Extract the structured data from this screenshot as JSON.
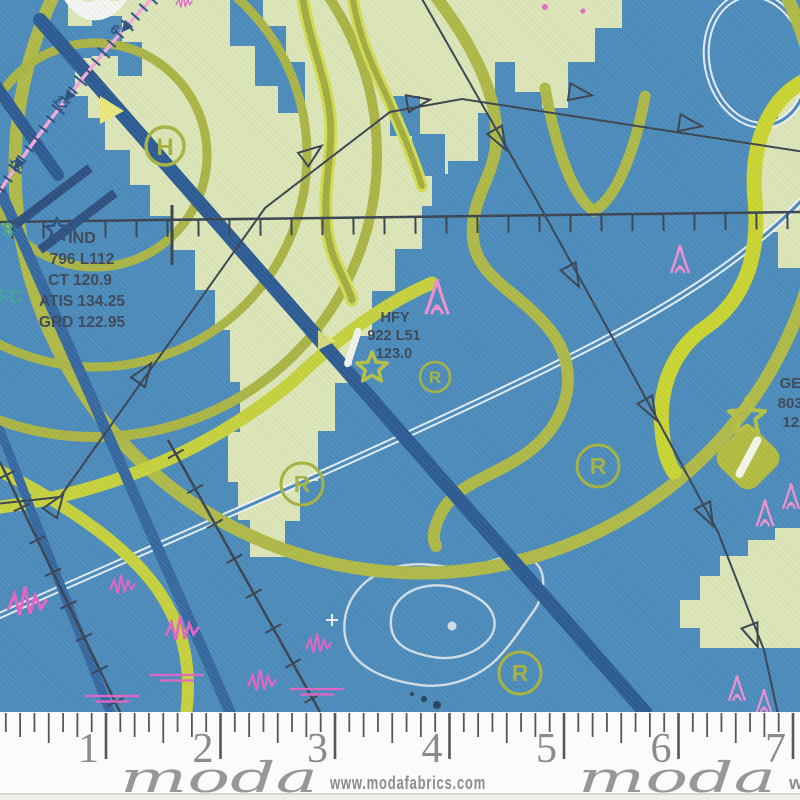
{
  "fabric": {
    "airports": {
      "ind": {
        "name": "IND",
        "line2": "796 L112",
        "line3": "CT 120.9",
        "line4": "ATIS 134.25",
        "line5": "GRD 122.95"
      },
      "hfy": {
        "name": "HFY",
        "line2": "922 L51",
        "line3": "123.0"
      },
      "gez": {
        "name": "GEZ",
        "line2": "803 L1",
        "line3": "122."
      }
    },
    "compass_labels": [
      "6",
      "12",
      "15"
    ],
    "airspace": {
      "partial_number": "8",
      "partial_text": "FC"
    },
    "helipad_letter": "H",
    "registered_letter": "R",
    "colors": {
      "water_blue": "#4A8ABA",
      "land_green": "#DCE5B6",
      "airspace_olive": "#AAB443",
      "bright_chartreuse": "#C9D42F",
      "airway_navy": "#2B5A92",
      "obstacle_pink": "#E06AC6",
      "compass_pink": "#F2A8D8",
      "chart_ink": "#39434F"
    }
  },
  "ruler": {
    "numbers": [
      "1",
      "2",
      "3",
      "4",
      "5",
      "6",
      "7"
    ]
  },
  "branding": {
    "logo": "moda",
    "url": "www.modafabrics.com",
    "logo_repeat": "moda",
    "url_partial": "w"
  }
}
